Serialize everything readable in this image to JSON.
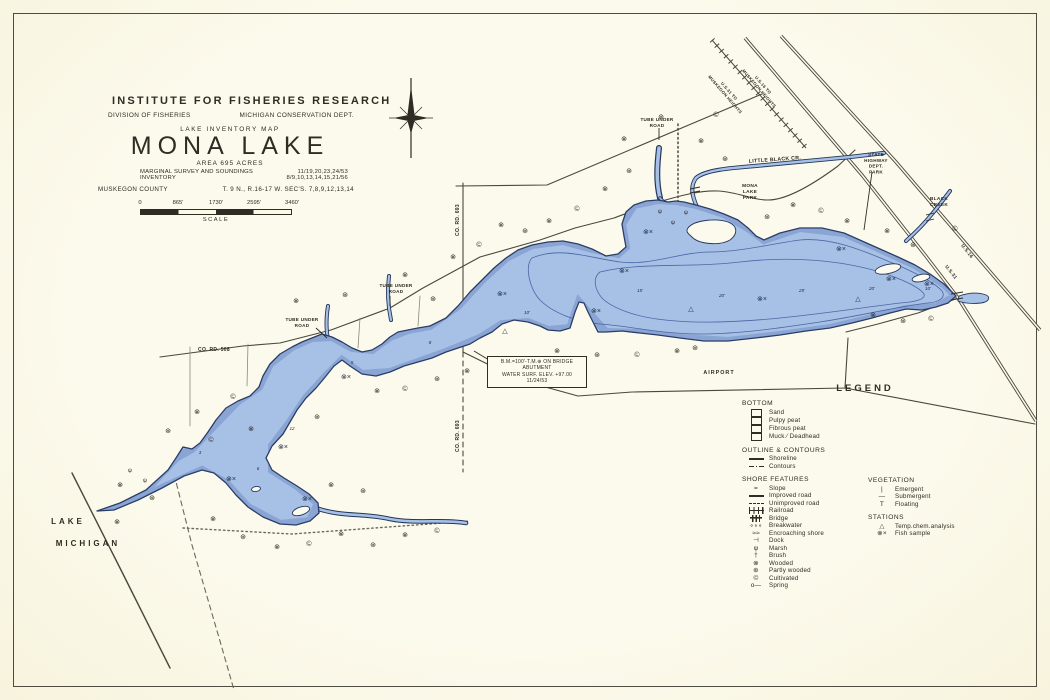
{
  "title_block": {
    "institute": "INSTITUTE FOR FISHERIES RESEARCH",
    "division": "DIVISION OF FISHERIES",
    "dept": "MICHIGAN CONSERVATION DEPT.",
    "map_type": "LAKE INVENTORY MAP",
    "lake_name": "MONA LAKE",
    "area": "AREA  695  ACRES",
    "survey_label": "MARGINAL SURVEY AND SOUNDINGS",
    "survey_dates": "11/19,20,23,24/53",
    "inventory_label": "INVENTORY",
    "inventory_dates": "8/9,10,13,14,15,21/56",
    "county": "MUSKEGON COUNTY",
    "township": "T. 9 N., R.16-17 W.  SEC'S. 7,8,9,12,13,14",
    "scale_ticks": [
      "0",
      "865'",
      "1730'",
      "2595'",
      "3460'"
    ],
    "scale_label": "SCALE"
  },
  "note_box": {
    "lines": [
      "B.M.=100'-T.M.⊕ ON BRIDGE",
      "ABUTMENT",
      "WATER SURF. ELEV. +97.00",
      "11/24/53"
    ]
  },
  "legend": {
    "title": "LEGEND",
    "sections": [
      {
        "name": "BOTTOM",
        "column": "left",
        "items": [
          {
            "symbol": "box",
            "label": "Sand"
          },
          {
            "symbol": "box",
            "label": "Pulpy peat"
          },
          {
            "symbol": "box",
            "label": "Fibrous peat"
          },
          {
            "symbol": "box",
            "label": "Muck ⁄ Deadhead"
          }
        ]
      },
      {
        "name": "OUTLINE & CONTOURS",
        "column": "left",
        "items": [
          {
            "symbol": "shoreline",
            "label": "Shoreline"
          },
          {
            "symbol": "contours",
            "label": "Contours"
          }
        ]
      },
      {
        "name": "SHORE FEATURES",
        "column": "left",
        "items": [
          {
            "symbol": "slope",
            "label": "Slope"
          },
          {
            "symbol": "improved-road",
            "label": "Improved road"
          },
          {
            "symbol": "unimproved-road",
            "label": "Unimproved road"
          },
          {
            "symbol": "railroad",
            "label": "Railroad"
          },
          {
            "symbol": "bridge",
            "label": "Bridge"
          },
          {
            "symbol": "breakwater",
            "label": "Breakwater"
          },
          {
            "symbol": "encroaching",
            "label": "Encroaching shore"
          },
          {
            "symbol": "dock",
            "label": "Dock"
          },
          {
            "symbol": "marsh",
            "label": "Marsh"
          },
          {
            "symbol": "brush",
            "label": "Brush"
          },
          {
            "symbol": "wooded",
            "label": "Wooded"
          },
          {
            "symbol": "partly-wooded",
            "label": "Partly wooded"
          },
          {
            "symbol": "cultivated",
            "label": "Cultivated"
          },
          {
            "symbol": "spring",
            "label": "Spring"
          }
        ]
      },
      {
        "name": "VEGETATION",
        "column": "right",
        "items": [
          {
            "symbol": "emergent",
            "label": "Emergent"
          },
          {
            "symbol": "submergent",
            "label": "Submergent"
          },
          {
            "symbol": "floating",
            "label": "Floating"
          }
        ]
      },
      {
        "name": "STATIONS",
        "column": "right",
        "items": [
          {
            "symbol": "temp",
            "label": "Temp.chem.analysis"
          },
          {
            "symbol": "fish",
            "label": "Fish sample"
          }
        ]
      }
    ]
  },
  "symbol_glyphs": {
    "slope": "=",
    "breakwater": "∘∘∘",
    "encroaching": "≈≈",
    "dock": "⊣",
    "marsh": "ψ",
    "brush": "†",
    "wooded": "⊗",
    "partly-wooded": "⊛",
    "cultivated": "©",
    "spring": "o—",
    "emergent": "|",
    "submergent": "—",
    "floating": "T",
    "temp": "△",
    "fish": "⊗×"
  },
  "map_labels": [
    {
      "lines": [
        "TUBE UNDER",
        "ROAD"
      ],
      "x": 657,
      "y": 121,
      "s": 4.6
    },
    {
      "lines": [
        "LITTLE  BLACK  CR."
      ],
      "x": 775,
      "y": 161,
      "s": 5.2,
      "rot": -4
    },
    {
      "lines": [
        "MONA",
        "LAKE",
        "PARK"
      ],
      "x": 750,
      "y": 187,
      "s": 4.8
    },
    {
      "lines": [
        "STATE",
        "HIGHWAY",
        "DEPT.",
        "PARK"
      ],
      "x": 876,
      "y": 156,
      "s": 4.6
    },
    {
      "lines": [
        "BLACK",
        "CREEK"
      ],
      "x": 939,
      "y": 200,
      "s": 4.8
    },
    {
      "lines": [
        "U.S.31 TO",
        "MUSKEGON HEIGHTS"
      ],
      "x": 728,
      "y": 92,
      "s": 4.2,
      "rot": 49
    },
    {
      "lines": [
        "U.S.16 TO",
        "MUSKEGON HEIGHTS"
      ],
      "x": 762,
      "y": 86,
      "s": 4.2,
      "rot": 49
    },
    {
      "lines": [
        "U.S.31"
      ],
      "x": 950,
      "y": 273,
      "s": 4.8,
      "rot": 52
    },
    {
      "lines": [
        "U.S.16"
      ],
      "x": 966,
      "y": 252,
      "s": 4.8,
      "rot": 52
    },
    {
      "lines": [
        "TUBE UNDER",
        "ROAD"
      ],
      "x": 396,
      "y": 287,
      "s": 4.6
    },
    {
      "lines": [
        "TUBE UNDER",
        "ROAD"
      ],
      "x": 302,
      "y": 321,
      "s": 4.6
    },
    {
      "lines": [
        "CO. RD. 508"
      ],
      "x": 214,
      "y": 351,
      "s": 5
    },
    {
      "lines": [
        "CO. RD. 693"
      ],
      "x": 459,
      "y": 220,
      "s": 5,
      "rot": -90
    },
    {
      "lines": [
        "CO. RD. 693"
      ],
      "x": 459,
      "y": 436,
      "s": 5,
      "rot": -90
    },
    {
      "lines": [
        "AIRPORT"
      ],
      "x": 719,
      "y": 374,
      "s": 5.4,
      "sp": 1
    },
    {
      "lines": [
        "LAKE"
      ],
      "x": 68,
      "y": 524,
      "s": 8,
      "sp": 3
    },
    {
      "lines": [
        "MICHIGAN"
      ],
      "x": 88,
      "y": 546,
      "s": 8,
      "sp": 3
    }
  ],
  "depth_labels": [
    {
      "t": "3",
      "x": 200,
      "y": 454
    },
    {
      "t": "5",
      "x": 352,
      "y": 364
    },
    {
      "t": "8",
      "x": 430,
      "y": 344
    },
    {
      "t": "10'",
      "x": 527,
      "y": 314
    },
    {
      "t": "15'",
      "x": 640,
      "y": 292
    },
    {
      "t": "20'",
      "x": 722,
      "y": 297
    },
    {
      "t": "25'",
      "x": 802,
      "y": 292
    },
    {
      "t": "20'",
      "x": 872,
      "y": 290
    },
    {
      "t": "10'",
      "x": 928,
      "y": 290
    },
    {
      "t": "12",
      "x": 292,
      "y": 430
    },
    {
      "t": "6",
      "x": 258,
      "y": 470
    }
  ],
  "map_symbols": [
    {
      "type": "wooded",
      "x": 120,
      "y": 487
    },
    {
      "type": "partly-wooded",
      "x": 152,
      "y": 500
    },
    {
      "type": "wooded",
      "x": 117,
      "y": 524
    },
    {
      "type": "partly-wooded",
      "x": 168,
      "y": 433
    },
    {
      "type": "wooded",
      "x": 197,
      "y": 414
    },
    {
      "type": "cultivated",
      "x": 233,
      "y": 399
    },
    {
      "type": "wooded",
      "x": 296,
      "y": 303
    },
    {
      "type": "partly-wooded",
      "x": 345,
      "y": 297
    },
    {
      "type": "wooded",
      "x": 405,
      "y": 277
    },
    {
      "type": "partly-wooded",
      "x": 433,
      "y": 301
    },
    {
      "type": "wooded",
      "x": 453,
      "y": 259
    },
    {
      "type": "cultivated",
      "x": 479,
      "y": 247
    },
    {
      "type": "wooded",
      "x": 501,
      "y": 227
    },
    {
      "type": "partly-wooded",
      "x": 525,
      "y": 233
    },
    {
      "type": "wooded",
      "x": 549,
      "y": 223
    },
    {
      "type": "cultivated",
      "x": 577,
      "y": 211
    },
    {
      "type": "wooded",
      "x": 605,
      "y": 191
    },
    {
      "type": "partly-wooded",
      "x": 629,
      "y": 173
    },
    {
      "type": "wooded",
      "x": 624,
      "y": 141
    },
    {
      "type": "partly-wooded",
      "x": 661,
      "y": 119
    },
    {
      "type": "wooded",
      "x": 701,
      "y": 143
    },
    {
      "type": "partly-wooded",
      "x": 725,
      "y": 161
    },
    {
      "type": "cultivated",
      "x": 716,
      "y": 117
    },
    {
      "type": "partly-wooded",
      "x": 767,
      "y": 219
    },
    {
      "type": "wooded",
      "x": 793,
      "y": 207
    },
    {
      "type": "cultivated",
      "x": 821,
      "y": 213
    },
    {
      "type": "wooded",
      "x": 847,
      "y": 223
    },
    {
      "type": "wooded",
      "x": 887,
      "y": 233
    },
    {
      "type": "partly-wooded",
      "x": 913,
      "y": 247
    },
    {
      "type": "cultivated",
      "x": 955,
      "y": 231
    },
    {
      "type": "wooded",
      "x": 873,
      "y": 317
    },
    {
      "type": "partly-wooded",
      "x": 903,
      "y": 323
    },
    {
      "type": "cultivated",
      "x": 931,
      "y": 321
    },
    {
      "type": "wooded",
      "x": 557,
      "y": 353
    },
    {
      "type": "partly-wooded",
      "x": 597,
      "y": 357
    },
    {
      "type": "cultivated",
      "x": 637,
      "y": 357
    },
    {
      "type": "wooded",
      "x": 677,
      "y": 353
    },
    {
      "type": "partly-wooded",
      "x": 695,
      "y": 350
    },
    {
      "type": "wooded",
      "x": 377,
      "y": 393
    },
    {
      "type": "cultivated",
      "x": 405,
      "y": 391
    },
    {
      "type": "partly-wooded",
      "x": 437,
      "y": 381
    },
    {
      "type": "wooded",
      "x": 467,
      "y": 373
    },
    {
      "type": "wooded",
      "x": 251,
      "y": 431
    },
    {
      "type": "partly-wooded",
      "x": 317,
      "y": 419
    },
    {
      "type": "cultivated",
      "x": 211,
      "y": 442
    },
    {
      "type": "wooded",
      "x": 213,
      "y": 521
    },
    {
      "type": "partly-wooded",
      "x": 243,
      "y": 539
    },
    {
      "type": "wooded",
      "x": 277,
      "y": 549
    },
    {
      "type": "cultivated",
      "x": 309,
      "y": 546
    },
    {
      "type": "wooded",
      "x": 341,
      "y": 536
    },
    {
      "type": "partly-wooded",
      "x": 373,
      "y": 547
    },
    {
      "type": "wooded",
      "x": 405,
      "y": 537
    },
    {
      "type": "cultivated",
      "x": 437,
      "y": 533
    },
    {
      "type": "wooded",
      "x": 331,
      "y": 487
    },
    {
      "type": "partly-wooded",
      "x": 363,
      "y": 493
    },
    {
      "type": "fish",
      "x": 502,
      "y": 296
    },
    {
      "type": "fish",
      "x": 596,
      "y": 313
    },
    {
      "type": "fish",
      "x": 648,
      "y": 234
    },
    {
      "type": "fish",
      "x": 624,
      "y": 273
    },
    {
      "type": "fish",
      "x": 762,
      "y": 301
    },
    {
      "type": "fish",
      "x": 841,
      "y": 251
    },
    {
      "type": "fish",
      "x": 891,
      "y": 281
    },
    {
      "type": "fish",
      "x": 929,
      "y": 286
    },
    {
      "type": "fish",
      "x": 346,
      "y": 379
    },
    {
      "type": "fish",
      "x": 283,
      "y": 449
    },
    {
      "type": "fish",
      "x": 231,
      "y": 481
    },
    {
      "type": "fish",
      "x": 307,
      "y": 501
    },
    {
      "type": "temp",
      "x": 505,
      "y": 333
    },
    {
      "type": "temp",
      "x": 691,
      "y": 311
    },
    {
      "type": "temp",
      "x": 858,
      "y": 301
    },
    {
      "type": "marsh",
      "x": 660,
      "y": 213
    },
    {
      "type": "marsh",
      "x": 673,
      "y": 224
    },
    {
      "type": "marsh",
      "x": 686,
      "y": 214
    },
    {
      "type": "marsh",
      "x": 130,
      "y": 472
    },
    {
      "type": "marsh",
      "x": 145,
      "y": 482
    }
  ],
  "colors": {
    "paper": "#fbf8e6",
    "ink": "#2e2c24",
    "water_fill": "#a7c0e6",
    "water_edge": "#24365c",
    "contour": "#4a67a8",
    "road": "#4a483c"
  }
}
